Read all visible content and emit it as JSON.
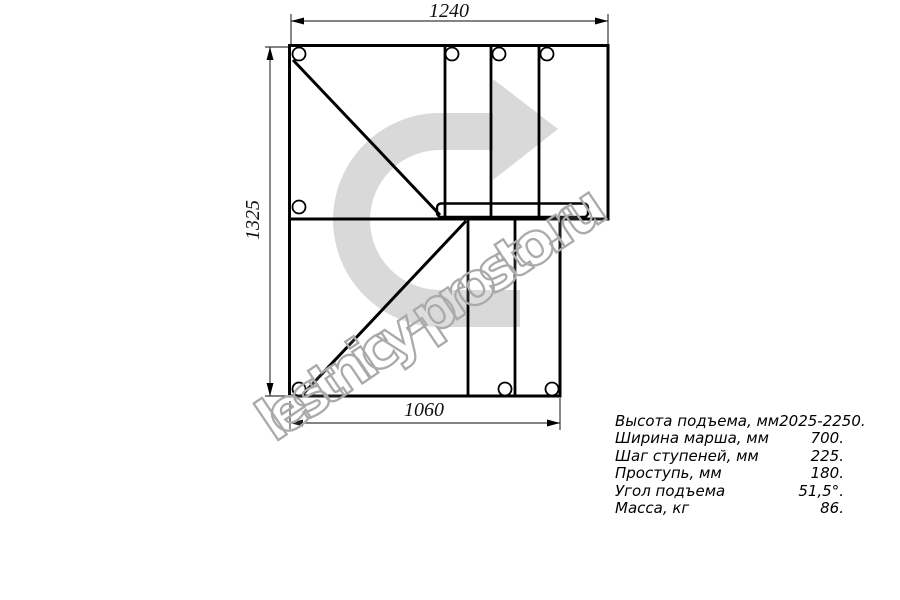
{
  "colors": {
    "arrow_fill": "#d9d9d9",
    "watermark_outline": "#aaaaaa",
    "drawing_line": "#000000"
  },
  "watermark": {
    "text": "lestnicy-prosto.ru"
  },
  "dimensions": {
    "top_width_mm": "1240",
    "left_height_mm": "1325",
    "bottom_width_mm": "1060"
  },
  "specs": {
    "rows": [
      {
        "label": "Высота подъема, мм",
        "value": "2025-2250."
      },
      {
        "label": "Ширина марша, мм",
        "value": "700."
      },
      {
        "label": "Шаг ступеней, мм",
        "value": "225."
      },
      {
        "label": "Проступь, мм",
        "value": "180."
      },
      {
        "label": "Угол подъема",
        "value": "51,5°."
      },
      {
        "label": "Масса, кг",
        "value": "86."
      }
    ]
  }
}
